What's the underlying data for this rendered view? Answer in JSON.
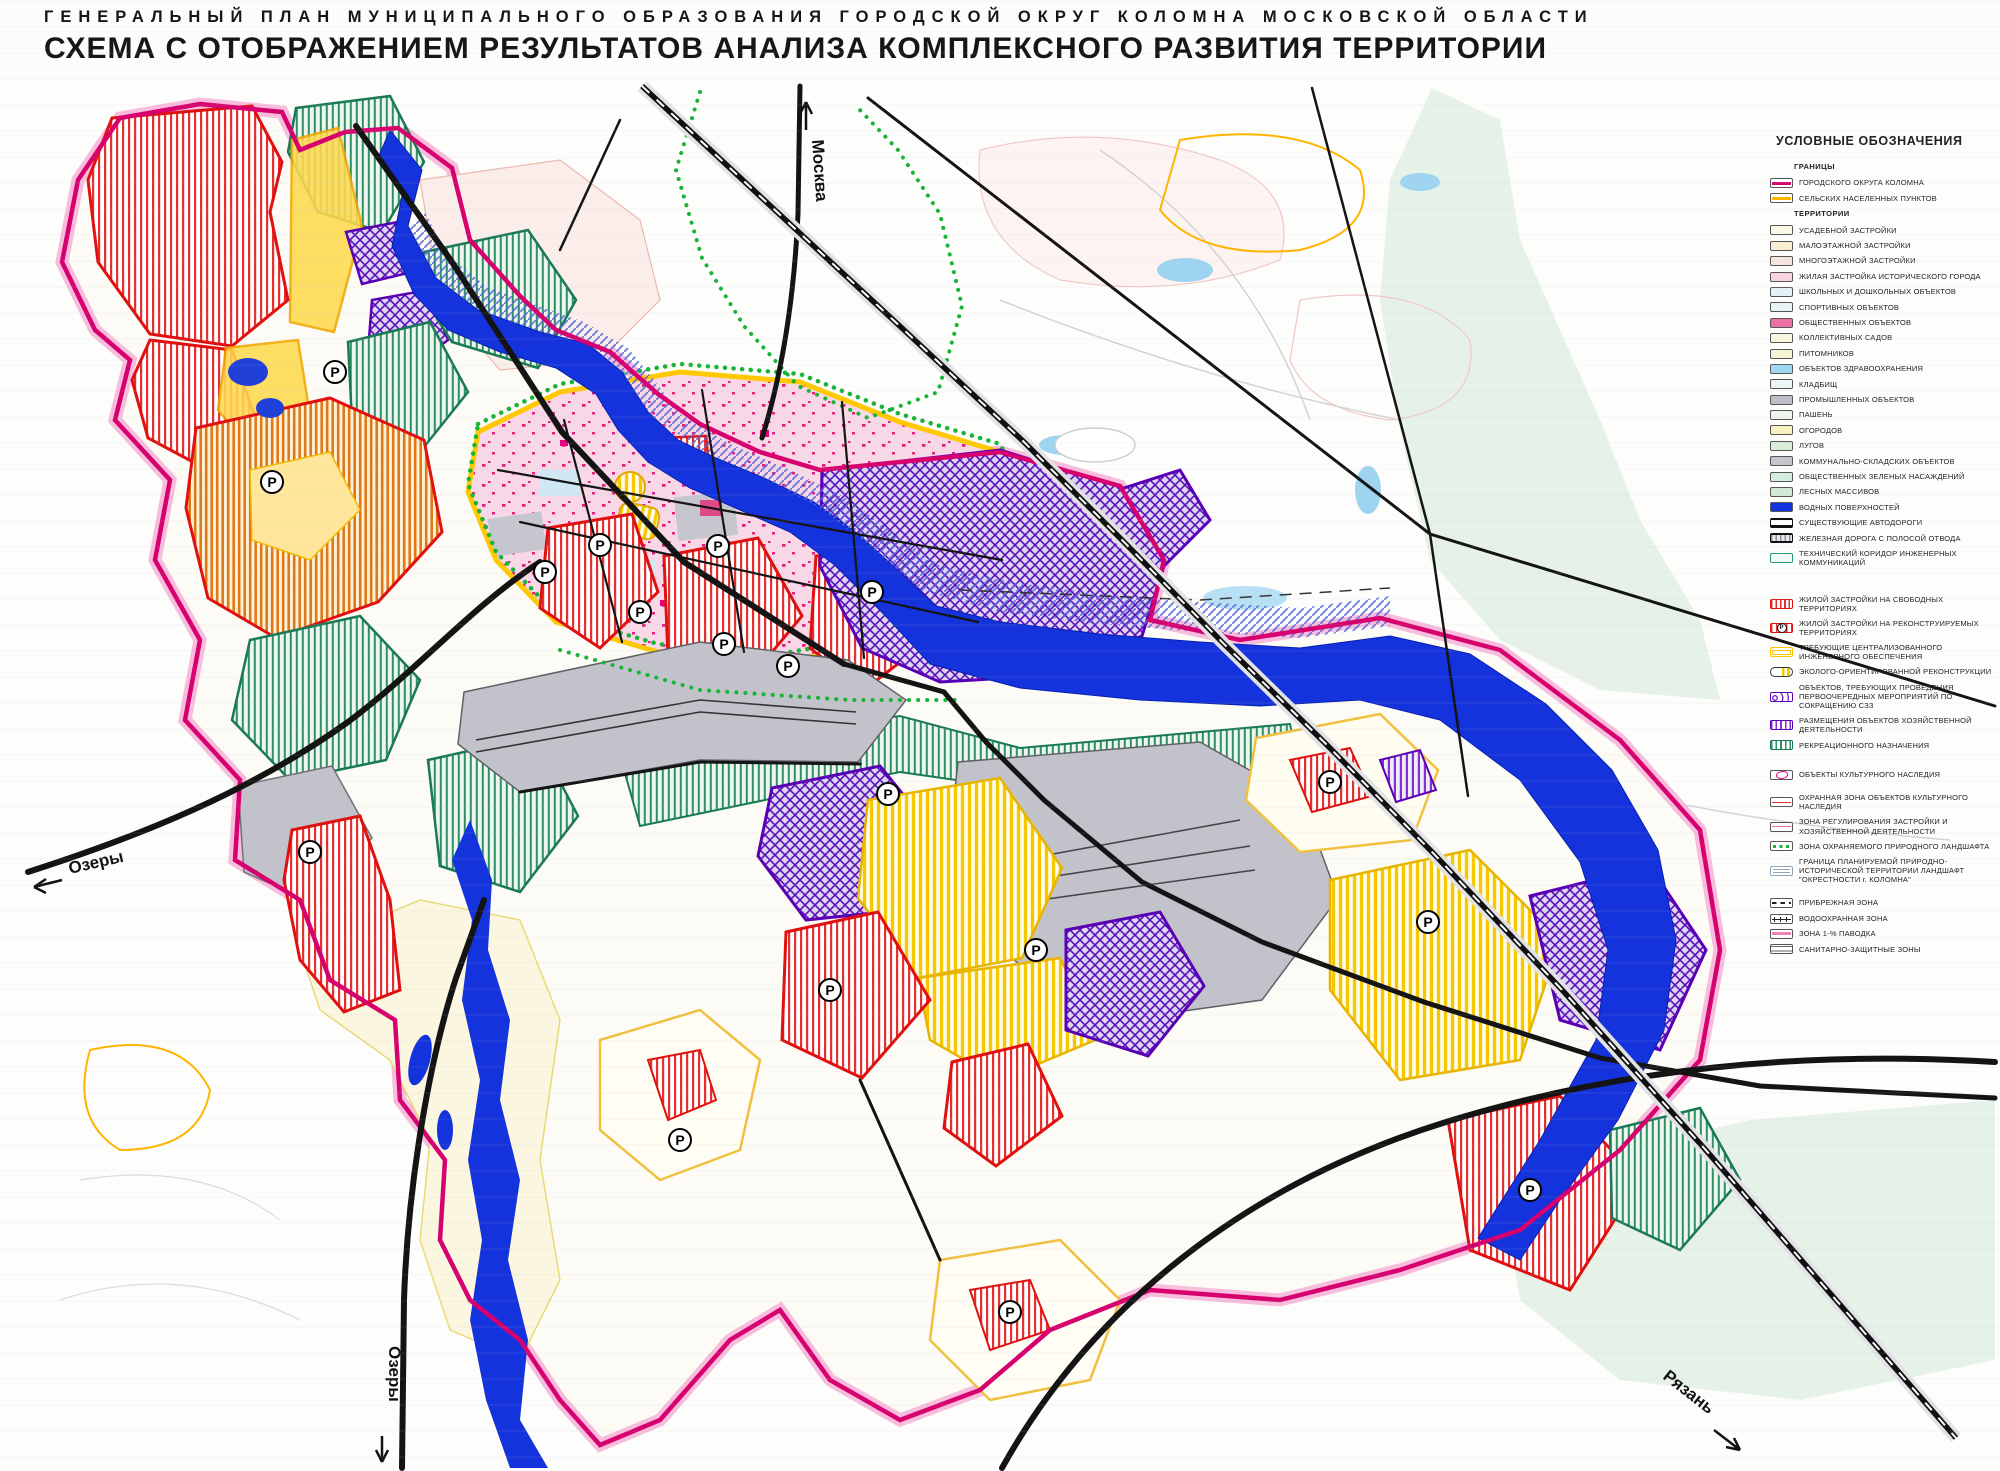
{
  "header": {
    "supertitle": "ГЕНЕРАЛЬНЫЙ ПЛАН МУНИЦИПАЛЬНОГО ОБРАЗОВАНИЯ ГОРОДСКОЙ ОКРУГ КОЛОМНА МОСКОВСКОЙ ОБЛАСТИ",
    "title": "СХЕМА С ОТОБРАЖЕНИЕМ РЕЗУЛЬТАТОВ АНАЛИЗА КОМПЛЕКСНОГО РАЗВИТИЯ ТЕРРИТОРИИ"
  },
  "map_labels": {
    "moscow": "Москва",
    "ozery_west": "Озеры",
    "ozery_south": "Озеры",
    "ryazan": "Рязань",
    "p": "P"
  },
  "colors": {
    "boundary_magenta": "#d6006e",
    "settlement_orange": "#ffb400",
    "water_blue": "#1433dc",
    "free_territory_red": "#e01010",
    "engineering_yellow": "#ffc800",
    "szz_purple": "#5a00b4",
    "recreation_teal": "#117a5a",
    "heritage_magenta": "#e6007e",
    "flood_pink": "#f4a0c8",
    "protected_landscape_green": "#19b339"
  },
  "legend": {
    "title": "УСЛОВНЫЕ ОБОЗНАЧЕНИЯ",
    "section_borders": "ГРАНИЦЫ",
    "section_territories": "ТЕРРИТОРИИ",
    "items": [
      {
        "label": "ГОРОДСКОГО ОКРУГА КОЛОМНА",
        "color": "#d6006e"
      },
      {
        "label": "СЕЛЬСКИХ НАСЕЛЕННЫХ ПУНКТОВ",
        "color": "#ffb400"
      },
      {
        "label": "УСАДЕБНОЙ ЗАСТРОЙКИ",
        "color": "#fcf8e8"
      },
      {
        "label": "МАЛОЭТАЖНОЙ ЗАСТРОЙКИ",
        "color": "#f9eed3"
      },
      {
        "label": "МНОГОЭТАЖНОЙ ЗАСТРОЙКИ",
        "color": "#f7e6de"
      },
      {
        "label": "ЖИЛАЯ ЗАСТРОЙКА ИСТОРИЧЕСКОГО ГОРОДА",
        "color": "#f8d2e0"
      },
      {
        "label": "ШКОЛЬНЫХ И ДОШКОЛЬНЫХ ОБЪЕКТОВ",
        "color": "#e4f1f7"
      },
      {
        "label": "СПОРТИВНЫХ ОБЪЕКТОВ",
        "color": "#e9f4f7"
      },
      {
        "label": "ОБЩЕСТВЕННЫХ ОБЪЕКТОВ",
        "color": "#ec6fa5"
      },
      {
        "label": "КОЛЛЕКТИВНЫХ САДОВ",
        "color": "#f8f7e0"
      },
      {
        "label": "ПИТОМНИКОВ",
        "color": "#f3f5d5"
      },
      {
        "label": "ОБЪЕКТОВ ЗДРАВООХРАНЕНИЯ",
        "color": "#9ed9f2"
      },
      {
        "label": "КЛАДБИЩ",
        "color": "#eef5f7"
      },
      {
        "label": "ПРОМЫШЛЕННЫХ ОБЪЕКТОВ",
        "color": "#bfbfc7"
      },
      {
        "label": "ПАШЕНЬ",
        "color": "#edf5ec"
      },
      {
        "label": "ОГОРОДОВ",
        "color": "#f8f2c0"
      },
      {
        "label": "ЛУГОВ",
        "color": "#daeddb"
      },
      {
        "label": "КОММУНАЛЬНО-СКЛАДСКИХ ОБЪЕКТОВ",
        "color": "#c5c5cd"
      },
      {
        "label": "ОБЩЕСТВЕННЫХ ЗЕЛЕНЫХ НАСАЖДЕНИЙ",
        "color": "#d6ecdc"
      },
      {
        "label": "ЛЕСНЫХ МАССИВОВ",
        "color": "#d2e9d6"
      },
      {
        "label": "ВОДНЫХ ПОВЕРХНОСТЕЙ",
        "color": "#1433e0"
      },
      {
        "label": "СУЩЕСТВУЮЩИЕ АВТОДОРОГИ"
      },
      {
        "label": "ЖЕЛЕЗНАЯ ДОРОГА С ПОЛОСОЙ ОТВОДА"
      },
      {
        "label": "ТЕХНИЧЕСКИЙ КОРИДОР ИНЖЕНЕРНЫХ КОММУНИКАЦИЙ"
      },
      {
        "label": "ЖИЛОЙ ЗАСТРОЙКИ НА СВОБОДНЫХ ТЕРРИТОРИЯХ"
      },
      {
        "label": "ЖИЛОЙ ЗАСТРОЙКИ НА РЕКОНСТРУИРУЕМЫХ ТЕРРИТОРИЯХ"
      },
      {
        "label": "ТРЕБУЮЩИЕ ЦЕНТРАЛИЗОВАННОГО ИНЖЕНЕРНОГО ОБЕСПЕЧЕНИЯ"
      },
      {
        "label": "ЭКОЛОГО-ОРИЕНТИРОВАННОЙ РЕКОНСТРУКЦИИ"
      },
      {
        "label": "ОБЪЕКТОВ, ТРЕБУЮЩИХ ПРОВЕДЕНИЯ ПЕРВООЧЕРЕДНЫХ МЕРОПРИЯТИЙ ПО СОКРАЩЕНИЮ СЗЗ"
      },
      {
        "label": "РАЗМЕЩЕНИЯ ОБЪЕКТОВ ХОЗЯЙСТВЕННОЙ ДЕЯТЕЛЬНОСТИ"
      },
      {
        "label": "РЕКРЕАЦИОННОГО НАЗНАЧЕНИЯ"
      },
      {
        "label": "ОБЪЕКТЫ КУЛЬТУРНОГО НАСЛЕДИЯ"
      },
      {
        "label": "ОХРАННАЯ ЗОНА ОБЪЕКТОВ КУЛЬТУРНОГО НАСЛЕДИЯ",
        "color": "#e03030"
      },
      {
        "label": "ЗОНА РЕГУЛИРОВАНИЯ ЗАСТРОЙКИ И ХОЗЯЙСТВЕННОЙ ДЕЯТЕЛЬНОСТИ",
        "color": "#e87098"
      },
      {
        "label": "ЗОНА ОХРАНЯЕМОГО ПРИРОДНОГО ЛАНДШАФТА"
      },
      {
        "label": "ГРАНИЦА ПЛАНИРУЕМОЙ ПРИРОДНО-ИСТОРИЧЕСКОЙ ТЕРРИТОРИИ ЛАНДШАФТ \"ОКРЕСТНОСТИ г. КОЛОМНА\""
      },
      {
        "label": "ПРИБРЕЖНАЯ ЗОНА"
      },
      {
        "label": "ВОДООХРАННАЯ ЗОНА"
      },
      {
        "label": "ЗОНА 1-% ПАВОДКА",
        "color": "#f080b8"
      },
      {
        "label": "САНИТАРНО-ЗАЩИТНЫЕ ЗОНЫ"
      }
    ]
  }
}
